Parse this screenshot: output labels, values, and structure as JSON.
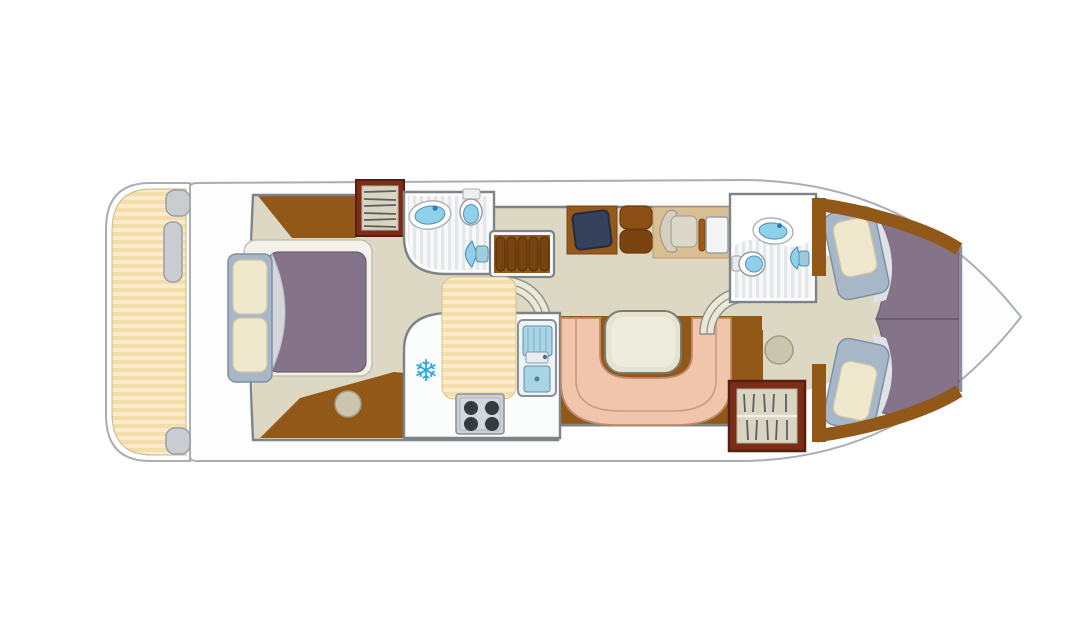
{
  "canvas": {
    "width": 1092,
    "height": 640,
    "background": "#FFFFFF"
  },
  "icons": {
    "snowflake": "❄"
  },
  "colors": {
    "page-bg": "#FFFFFF",
    "hull-fill": "#FDFDFD",
    "hull-stroke": "#A9AEB3",
    "wall-gray": "#7E8388",
    "floor-beige": "#DDD8C3",
    "wood-brown": "#925817",
    "wood-dark": "#77430F",
    "stripe-a": "#F3DDAA",
    "stripe-b": "#FAECCB",
    "bath-stripe-a": "#E3E7EA",
    "bath-stripe-b": "#F6F8F9",
    "duvet-purple": "#857389",
    "bed-frame-blue": "#A7B7C8",
    "pillow-cream": "#EFE8CD",
    "bench-salmon": "#F0C5AB",
    "bench-line": "#CE9A7E",
    "table-cream": "#E6E3D2",
    "fixture-blue": "#8FD0EA",
    "fixture-blue-dark": "#2F7CB4",
    "stove-gray": "#CBD0D3",
    "burner-dark": "#343A40",
    "screen-navy": "#36425C",
    "wardrobe-frame": "#7B2D18",
    "wardrobe-inner": "#D9D5C1",
    "hanger-gray": "#5A5F66",
    "stool-beige": "#CBC5AE",
    "desk-tan": "#D9BD93",
    "seat-brown": "#8B4F16",
    "landing-cream": "#ECE8D6",
    "snowflake-blue": "#2AA9E0",
    "white": "#FFFFFF"
  }
}
